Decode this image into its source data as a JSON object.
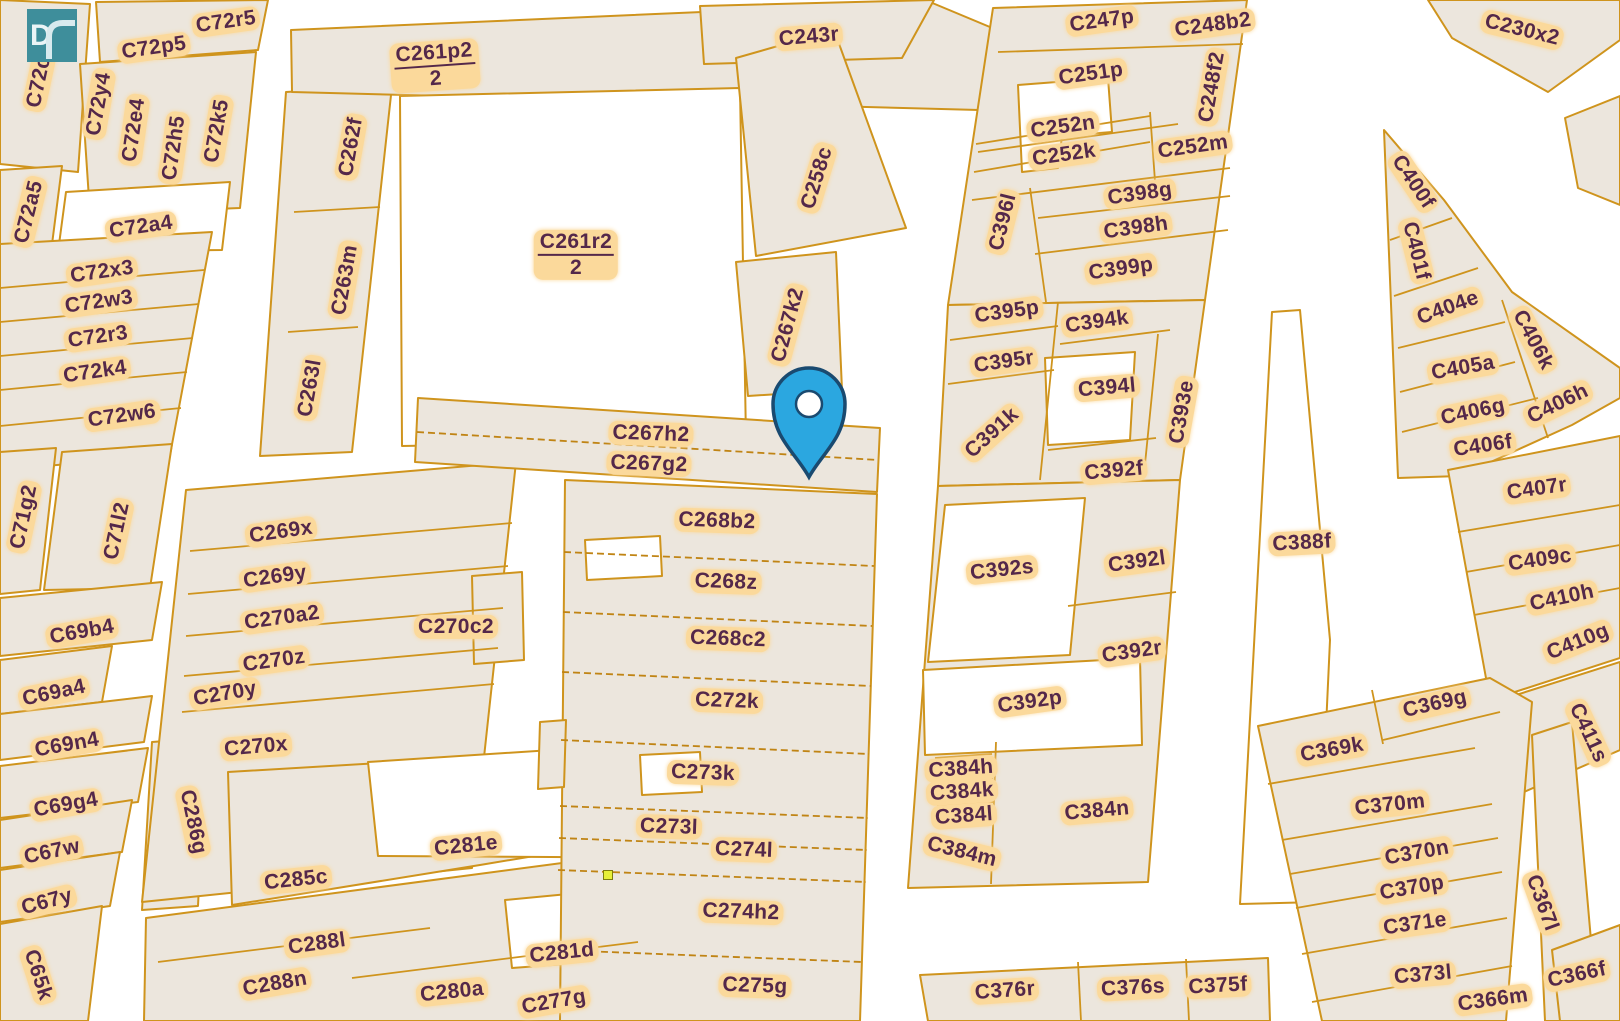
{
  "map": {
    "logo": {
      "letter": "D"
    },
    "pin": {
      "name": "location-pin"
    },
    "marker_dot": {
      "name": "waypoint-dot"
    },
    "colors": {
      "bg": "#ffffff",
      "parcel_fill": "#ece6dd",
      "border": "#cf941d",
      "border_dark": "#c08414",
      "label_text": "#54284a",
      "label_halo": "#fbd99b",
      "pin_fill": "#2ba7e0",
      "pin_stroke": "#1a4a70",
      "dot_fill": "#e6ef38",
      "logo_bg": "#3e8e9b"
    },
    "labels": [
      {
        "t": "C72c",
        "x": 39,
        "y": 82,
        "r": -78
      },
      {
        "t": "C72r5",
        "x": 226,
        "y": 22,
        "r": -8
      },
      {
        "t": "C72p5",
        "x": 154,
        "y": 48,
        "r": -8
      },
      {
        "t": "C72y4",
        "x": 99,
        "y": 104,
        "r": -80
      },
      {
        "t": "C72e4",
        "x": 134,
        "y": 130,
        "r": -82
      },
      {
        "t": "C72h5",
        "x": 174,
        "y": 148,
        "r": -82
      },
      {
        "t": "C72k5",
        "x": 217,
        "y": 131,
        "r": -80
      },
      {
        "t": "C72a5",
        "x": 29,
        "y": 212,
        "r": -76
      },
      {
        "t": "C72a4",
        "x": 141,
        "y": 227,
        "r": -8
      },
      {
        "t": "C72x3",
        "x": 102,
        "y": 272,
        "r": -8
      },
      {
        "t": "C72w3",
        "x": 99,
        "y": 302,
        "r": -8
      },
      {
        "t": "C72r3",
        "x": 98,
        "y": 337,
        "r": -8
      },
      {
        "t": "C72k4",
        "x": 95,
        "y": 372,
        "r": -8
      },
      {
        "t": "C72w6",
        "x": 122,
        "y": 416,
        "r": -8
      },
      {
        "t": "C71g2",
        "x": 24,
        "y": 517,
        "r": -78
      },
      {
        "t": "C71l2",
        "x": 117,
        "y": 531,
        "r": -78
      },
      {
        "t": "C69b4",
        "x": 82,
        "y": 632,
        "r": -10
      },
      {
        "t": "C69a4",
        "x": 54,
        "y": 693,
        "r": -12
      },
      {
        "t": "C69n4",
        "x": 67,
        "y": 745,
        "r": -10
      },
      {
        "t": "C69g4",
        "x": 66,
        "y": 805,
        "r": -10
      },
      {
        "t": "C67w",
        "x": 52,
        "y": 852,
        "r": -12
      },
      {
        "t": "C67y",
        "x": 47,
        "y": 902,
        "r": -15
      },
      {
        "t": "C65k",
        "x": 38,
        "y": 975,
        "r": 72
      },
      {
        "t": "C286g",
        "x": 193,
        "y": 822,
        "r": 78
      },
      {
        "t": "C262f",
        "x": 351,
        "y": 147,
        "r": -80
      },
      {
        "t": "C263m",
        "x": 345,
        "y": 280,
        "r": -80
      },
      {
        "t": "C263l",
        "x": 310,
        "y": 388,
        "r": -80
      },
      {
        "t": "C261p2",
        "d": "2",
        "x": 435,
        "y": 66,
        "r": -4
      },
      {
        "t": "C261r2",
        "d": "2",
        "x": 576,
        "y": 255,
        "r": 0
      },
      {
        "t": "C269x",
        "x": 281,
        "y": 532,
        "r": -8
      },
      {
        "t": "C269y",
        "x": 275,
        "y": 577,
        "r": -8
      },
      {
        "t": "C270a2",
        "x": 282,
        "y": 618,
        "r": -8
      },
      {
        "t": "C270z",
        "x": 274,
        "y": 661,
        "r": -8
      },
      {
        "t": "C270y",
        "x": 225,
        "y": 694,
        "r": -10
      },
      {
        "t": "C270x",
        "x": 256,
        "y": 747,
        "r": -5
      },
      {
        "t": "C270c2",
        "x": 456,
        "y": 627,
        "r": 0
      },
      {
        "t": "C281e",
        "x": 466,
        "y": 846,
        "r": -6
      },
      {
        "t": "C285c",
        "x": 296,
        "y": 880,
        "r": -6
      },
      {
        "t": "C288l",
        "x": 317,
        "y": 944,
        "r": -8
      },
      {
        "t": "C288n",
        "x": 275,
        "y": 984,
        "r": -10
      },
      {
        "t": "C280a",
        "x": 452,
        "y": 992,
        "r": -6
      },
      {
        "t": "C277g",
        "x": 554,
        "y": 1002,
        "r": -10
      },
      {
        "t": "C281d",
        "x": 562,
        "y": 953,
        "r": -6
      },
      {
        "t": "C243r",
        "x": 809,
        "y": 37,
        "r": -5
      },
      {
        "t": "C258c",
        "x": 817,
        "y": 178,
        "r": -73
      },
      {
        "t": "C267k2",
        "x": 788,
        "y": 325,
        "r": -75
      },
      {
        "t": "C267h2",
        "x": 651,
        "y": 434,
        "r": 2
      },
      {
        "t": "C267g2",
        "x": 649,
        "y": 464,
        "r": 2
      },
      {
        "t": "C268b2",
        "x": 717,
        "y": 521,
        "r": 2
      },
      {
        "t": "C268z",
        "x": 726,
        "y": 582,
        "r": 2
      },
      {
        "t": "C268c2",
        "x": 728,
        "y": 639,
        "r": 2
      },
      {
        "t": "C272k",
        "x": 727,
        "y": 701,
        "r": 2
      },
      {
        "t": "C273k",
        "x": 703,
        "y": 773,
        "r": 2
      },
      {
        "t": "C273l",
        "x": 669,
        "y": 827,
        "r": 2
      },
      {
        "t": "C274l",
        "x": 744,
        "y": 850,
        "r": 2
      },
      {
        "t": "C274h2",
        "x": 741,
        "y": 912,
        "r": 2
      },
      {
        "t": "C275g",
        "x": 755,
        "y": 986,
        "r": 2
      },
      {
        "t": "C247p",
        "x": 1102,
        "y": 21,
        "r": -8
      },
      {
        "t": "C248b2",
        "x": 1213,
        "y": 25,
        "r": -8
      },
      {
        "t": "C251p",
        "x": 1091,
        "y": 74,
        "r": -8
      },
      {
        "t": "C248f2",
        "x": 1212,
        "y": 87,
        "r": -80
      },
      {
        "t": "C252n",
        "x": 1063,
        "y": 127,
        "r": -8
      },
      {
        "t": "C252k",
        "x": 1064,
        "y": 155,
        "r": -8
      },
      {
        "t": "C252m",
        "x": 1193,
        "y": 147,
        "r": -8
      },
      {
        "t": "C398g",
        "x": 1140,
        "y": 194,
        "r": -8
      },
      {
        "t": "C398h",
        "x": 1136,
        "y": 228,
        "r": -8
      },
      {
        "t": "C399p",
        "x": 1121,
        "y": 269,
        "r": -8
      },
      {
        "t": "C396l",
        "x": 1003,
        "y": 222,
        "r": -76
      },
      {
        "t": "C395p",
        "x": 1007,
        "y": 312,
        "r": -8
      },
      {
        "t": "C394k",
        "x": 1097,
        "y": 322,
        "r": -8
      },
      {
        "t": "C395r",
        "x": 1004,
        "y": 362,
        "r": -8
      },
      {
        "t": "C394l",
        "x": 1107,
        "y": 388,
        "r": -5
      },
      {
        "t": "C393e",
        "x": 1182,
        "y": 412,
        "r": -80
      },
      {
        "t": "C391k",
        "x": 992,
        "y": 433,
        "r": -42
      },
      {
        "t": "C392f",
        "x": 1114,
        "y": 471,
        "r": -5
      },
      {
        "t": "C392s",
        "x": 1002,
        "y": 570,
        "r": -6
      },
      {
        "t": "C392l",
        "x": 1137,
        "y": 562,
        "r": -8
      },
      {
        "t": "C392r",
        "x": 1132,
        "y": 652,
        "r": -8
      },
      {
        "t": "C392p",
        "x": 1030,
        "y": 702,
        "r": -8
      },
      {
        "t": "C384h",
        "x": 961,
        "y": 769,
        "r": -4
      },
      {
        "t": "C384k",
        "x": 962,
        "y": 792,
        "r": -4
      },
      {
        "t": "C384l",
        "x": 964,
        "y": 816,
        "r": -4
      },
      {
        "t": "C384m",
        "x": 962,
        "y": 852,
        "r": 14
      },
      {
        "t": "C384n",
        "x": 1097,
        "y": 811,
        "r": -5
      },
      {
        "t": "C376r",
        "x": 1005,
        "y": 991,
        "r": -4
      },
      {
        "t": "C376s",
        "x": 1133,
        "y": 988,
        "r": -3
      },
      {
        "t": "C375f",
        "x": 1218,
        "y": 986,
        "r": -3
      },
      {
        "t": "C230x2",
        "x": 1522,
        "y": 30,
        "r": 14
      },
      {
        "t": "C400f",
        "x": 1413,
        "y": 182,
        "r": 56
      },
      {
        "t": "C401f",
        "x": 1416,
        "y": 251,
        "r": 76
      },
      {
        "t": "C404e",
        "x": 1448,
        "y": 308,
        "r": -20
      },
      {
        "t": "C406k",
        "x": 1533,
        "y": 340,
        "r": 62
      },
      {
        "t": "C405a",
        "x": 1463,
        "y": 368,
        "r": -10
      },
      {
        "t": "C406g",
        "x": 1473,
        "y": 412,
        "r": -12
      },
      {
        "t": "C406h",
        "x": 1558,
        "y": 404,
        "r": -26
      },
      {
        "t": "C406f",
        "x": 1483,
        "y": 446,
        "r": -8
      },
      {
        "t": "C407r",
        "x": 1537,
        "y": 489,
        "r": -8
      },
      {
        "t": "C409c",
        "x": 1540,
        "y": 560,
        "r": -8
      },
      {
        "t": "C410h",
        "x": 1562,
        "y": 598,
        "r": -12
      },
      {
        "t": "C410g",
        "x": 1578,
        "y": 642,
        "r": -22
      },
      {
        "t": "C411s",
        "x": 1588,
        "y": 733,
        "r": 65
      },
      {
        "t": "C388f",
        "x": 1302,
        "y": 543,
        "r": -3
      },
      {
        "t": "C369g",
        "x": 1435,
        "y": 704,
        "r": -13
      },
      {
        "t": "C369k",
        "x": 1332,
        "y": 750,
        "r": -10
      },
      {
        "t": "C370m",
        "x": 1390,
        "y": 805,
        "r": -6
      },
      {
        "t": "C370n",
        "x": 1417,
        "y": 853,
        "r": -10
      },
      {
        "t": "C370p",
        "x": 1412,
        "y": 888,
        "r": -10
      },
      {
        "t": "C371e",
        "x": 1415,
        "y": 924,
        "r": -8
      },
      {
        "t": "C373l",
        "x": 1423,
        "y": 975,
        "r": -5
      },
      {
        "t": "C366m",
        "x": 1493,
        "y": 1000,
        "r": -8
      },
      {
        "t": "C366f",
        "x": 1577,
        "y": 975,
        "r": -12
      },
      {
        "t": "C367l",
        "x": 1542,
        "y": 903,
        "r": 70
      }
    ]
  }
}
